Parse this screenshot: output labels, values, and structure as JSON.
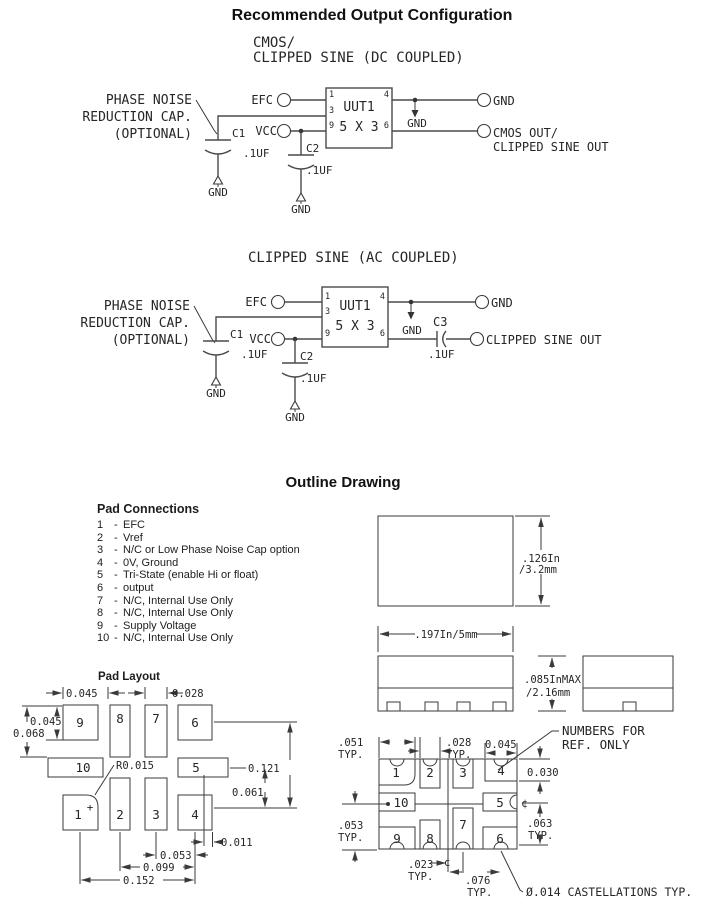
{
  "header": {
    "title": "Recommended Output Configuration"
  },
  "colors": {
    "ink": "#262626",
    "line": "#3a3a3a",
    "background": "#ffffff"
  },
  "circuit_dc": {
    "subtitle1": "CMOS/",
    "subtitle2": "CLIPPED SINE (DC COUPLED)",
    "note1": "PHASE NOISE",
    "note2": "REDUCTION CAP.",
    "note3": "(OPTIONAL)",
    "efc": "EFC",
    "vcc": "VCC",
    "uut": "UUT1",
    "uut_size": "5 X 3",
    "pin1": "1",
    "pin3": "3",
    "pin9": "9",
    "pin4": "4",
    "pin6": "6",
    "c1": "C1",
    "c2": "C2",
    "cap_value": ".1UF",
    "gnd": "GND",
    "out_line1": "CMOS OUT/",
    "out_line2": "CLIPPED SINE OUT"
  },
  "circuit_ac": {
    "subtitle": "CLIPPED SINE (AC COUPLED)",
    "note1": "PHASE NOISE",
    "note2": "REDUCTION CAP.",
    "note3": "(OPTIONAL)",
    "efc": "EFC",
    "vcc": "VCC",
    "uut": "UUT1",
    "uut_size": "5 X 3",
    "pin1": "1",
    "pin3": "3",
    "pin9": "9",
    "pin4": "4",
    "pin6": "6",
    "c1": "C1",
    "c2": "C2",
    "c3": "C3",
    "cap_value": ".1UF",
    "gnd": "GND",
    "out": "CLIPPED SINE OUT"
  },
  "outline": {
    "title": "Outline Drawing",
    "dims": {
      "height_in": ".126In",
      "height_mm": "/3.2mm",
      "width": ".197In/5mm",
      "thick_in": ".085InMAX",
      "thick_mm": "/2.16mm"
    }
  },
  "pad_connections": {
    "heading": "Pad Connections",
    "dash": "-",
    "items": [
      {
        "num": "1",
        "desc": "EFC"
      },
      {
        "num": "2",
        "desc": "Vref"
      },
      {
        "num": "3",
        "desc": "N/C or Low Phase Noise Cap option"
      },
      {
        "num": "4",
        "desc": "0V, Ground"
      },
      {
        "num": "5",
        "desc": "Tri-State (enable Hi or float)"
      },
      {
        "num": "6",
        "desc": "output"
      },
      {
        "num": "7",
        "desc": "N/C, Internal Use Only"
      },
      {
        "num": "8",
        "desc": "N/C, Internal Use Only"
      },
      {
        "num": "9",
        "desc": "Supply Voltage"
      },
      {
        "num": "10",
        "desc": "N/C, Internal Use Only"
      }
    ]
  },
  "pad_numbers": {
    "p1": "1",
    "p2": "2",
    "p3": "3",
    "p4": "4",
    "p5": "5",
    "p6": "6",
    "p7": "7",
    "p8": "8",
    "p9": "9",
    "p10": "10"
  },
  "pad_layout": {
    "heading": "Pad Layout",
    "pin1_mark": "+",
    "dims": {
      "width_pad": "0.045",
      "gap": "0.028",
      "height_pad": "0.045",
      "height_total": "0.068",
      "corner_radius": "R0.015",
      "span_right": "0.121",
      "span_mid": "0.061",
      "offset": "0.011",
      "pitch_a": "0.053",
      "pitch_b": "0.099",
      "pitch_c": "0.152"
    }
  },
  "bottom_view": {
    "typ": "TYP.",
    "dims": {
      "d051": ".051",
      "d028": ".028",
      "d045": "0.045",
      "d030": "0.030",
      "d063": ".063",
      "d053": ".053",
      "d023": ".023",
      "d076": ".076"
    },
    "centerline": "¢",
    "note_line1": "NUMBERS FOR",
    "note_line2": "REF. ONLY",
    "castellation_note": "Ø.014 CASTELLATIONS TYP."
  }
}
